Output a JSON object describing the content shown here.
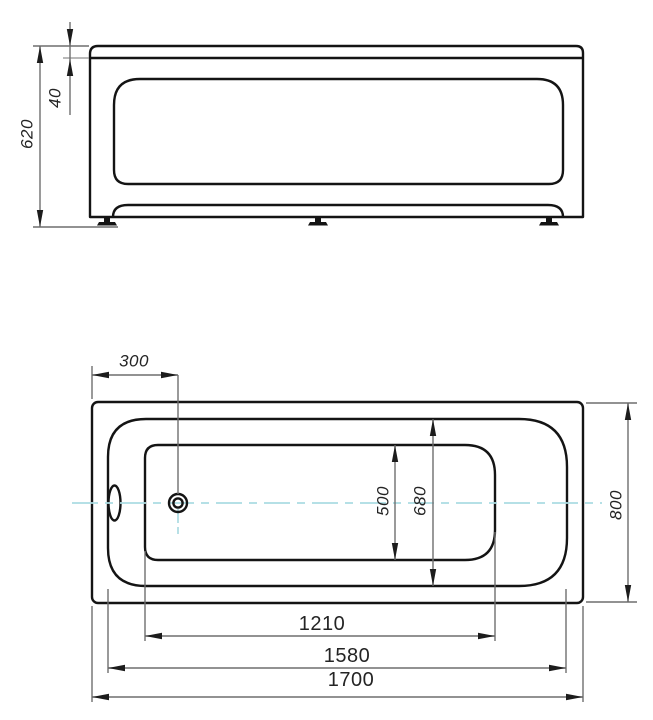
{
  "title": "Bathtub technical drawing — front elevation and plan view",
  "views": {
    "front": {
      "label": "front-elevation",
      "dimensions": {
        "total_height_mm": "620",
        "rim_height_mm": "40"
      }
    },
    "plan": {
      "label": "plan-view",
      "dimensions": {
        "drain_offset_mm": "300",
        "floor_width_mm": "500",
        "inner_width_mm": "680",
        "overall_width_mm": "800",
        "floor_length_mm": "1210",
        "inner_length_mm": "1580",
        "overall_length_mm": "1700"
      }
    }
  },
  "colors": {
    "object_line": "#141414",
    "dimension_line": "#6e6e6e",
    "extension_line": "#8f8f8f",
    "arrow": "#1c1c1c",
    "centerline": "#abdbe2",
    "text": "#242424",
    "background": "#ffffff"
  }
}
